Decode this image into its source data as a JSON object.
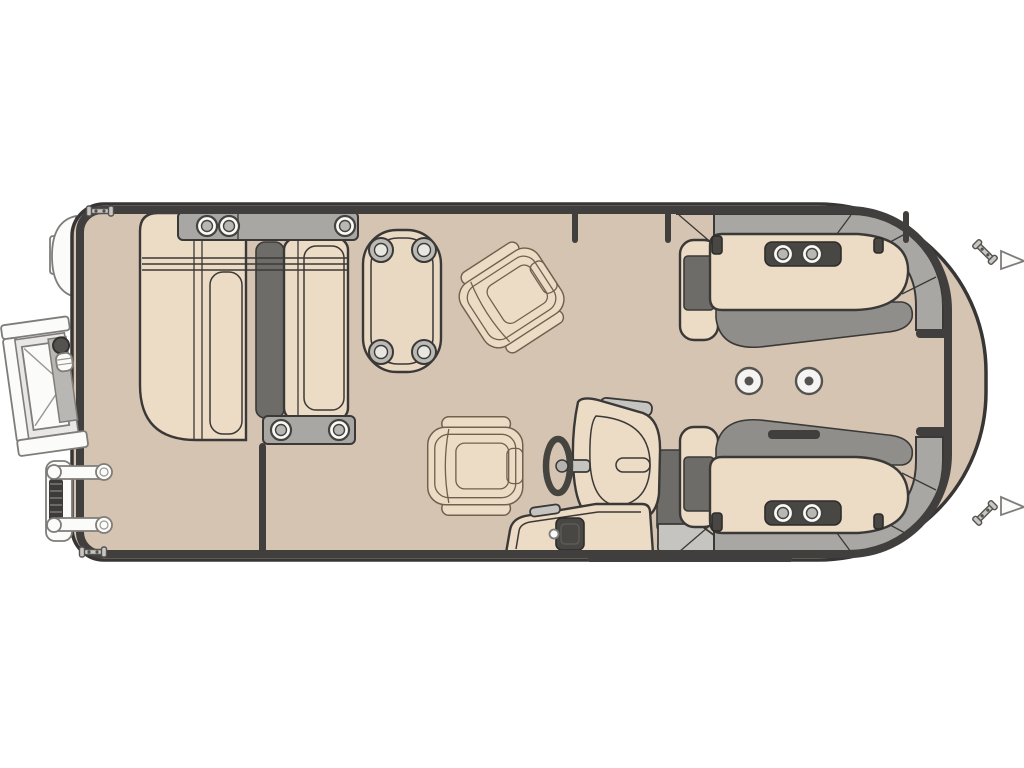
{
  "page": {
    "background": "#ffffff",
    "description": "Pontoon boat floor plan, top-down view, bow at left and rounded stern at right"
  },
  "palette": {
    "bg": "#ffffff",
    "deck": "#d5c4b2",
    "cushion": "#ecdbc5",
    "table_top": "#e9d8c2",
    "gray_base": "#a9a7a3",
    "gray_light": "#c6c4c0",
    "gray_mid": "#908e8a",
    "gray_dark": "#6e6c68",
    "fixture_dark": "#494743",
    "ink": "#3b3937",
    "rail": "#413f3d",
    "hull_line": "#383634",
    "white": "#fbfbfa",
    "chair_line": "#70604f",
    "metal_line": "#7f7d79"
  },
  "floorplan": {
    "seat_cup_holders": [
      {
        "x": 207,
        "y": 226
      },
      {
        "x": 229,
        "y": 226
      },
      {
        "x": 345,
        "y": 226
      },
      {
        "x": 281,
        "y": 430
      },
      {
        "x": 339,
        "y": 430
      },
      {
        "x": 783,
        "y": 254
      },
      {
        "x": 812,
        "y": 254
      },
      {
        "x": 783,
        "y": 513
      },
      {
        "x": 812,
        "y": 513
      }
    ],
    "table_cup_holders": [
      {
        "x": 381,
        "y": 250
      },
      {
        "x": 424,
        "y": 250
      },
      {
        "x": 381,
        "y": 352
      },
      {
        "x": 424,
        "y": 352
      }
    ],
    "deck_table_mounts": [
      {
        "x": 749,
        "y": 381
      },
      {
        "x": 809,
        "y": 381
      }
    ],
    "cleats": [
      {
        "x": 100,
        "y": 211,
        "rot": 0
      },
      {
        "x": 93,
        "y": 552,
        "rot": 0
      },
      {
        "x": 985,
        "y": 252,
        "rot": 45
      },
      {
        "x": 985,
        "y": 513,
        "rot": -45
      }
    ],
    "fence_posts": [
      {
        "x": 575
      },
      {
        "x": 668
      },
      {
        "x": 906
      }
    ],
    "rail_dashes": [
      {
        "x": 916,
        "y": 329,
        "w": 32,
        "h": 9
      },
      {
        "x": 916,
        "y": 427,
        "w": 32,
        "h": 9
      },
      {
        "x": 768,
        "y": 430,
        "w": 52,
        "h": 9
      },
      {
        "x": 259,
        "y": 443,
        "w": 7,
        "h": 113
      }
    ],
    "seat_seam_lines": {
      "x1": 142,
      "x2": 348,
      "ys": [
        258,
        264,
        270
      ]
    }
  }
}
